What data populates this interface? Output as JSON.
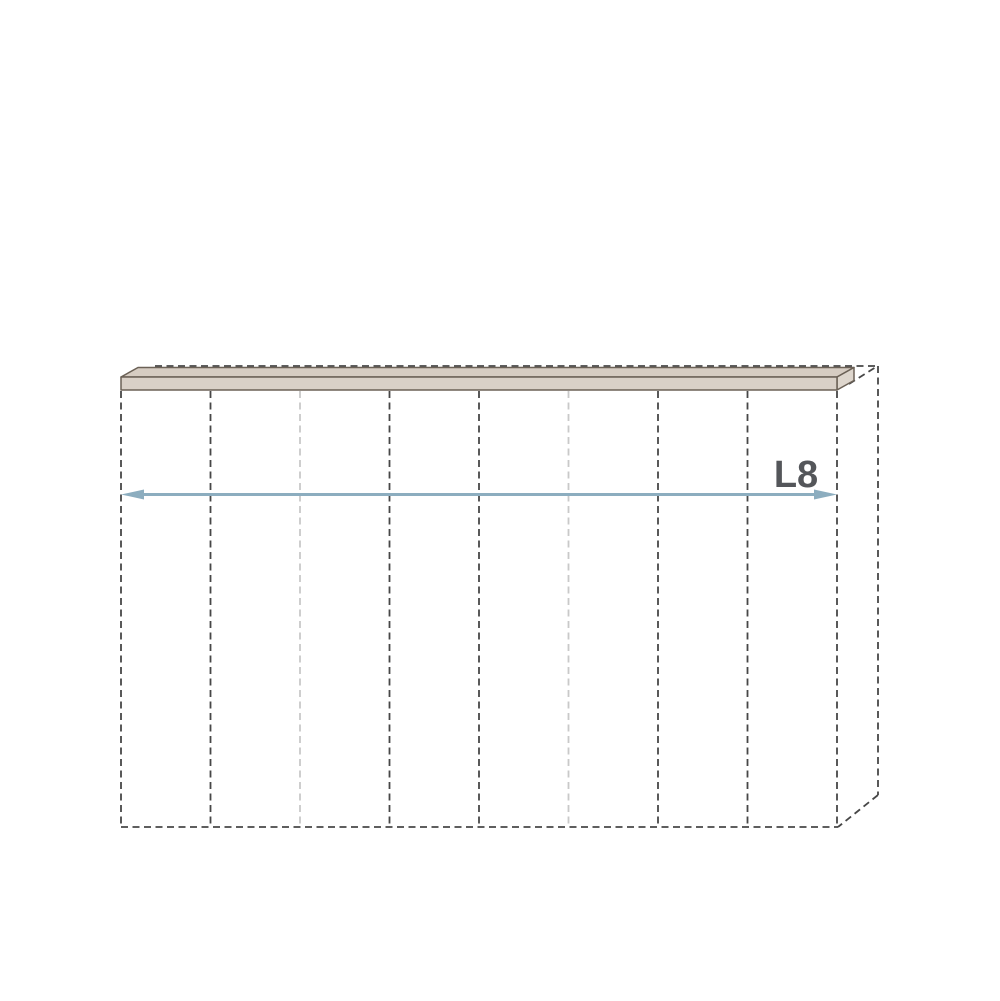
{
  "diagram": {
    "type": "wardrobe-configurator-dimension-drawing",
    "dimension_label": "L8",
    "highlighted_component": "top-panel",
    "sections_count": 8
  },
  "colors": {
    "background": "#ffffff",
    "dash-dark": "#474747",
    "dash-light": "#c9c9c9",
    "slab-top": "#d6ccc2",
    "slab-front": "#d9d0c7",
    "slab-end": "#ded6cd",
    "slab-outline": "#6b6156",
    "arrow": "#8cadbf",
    "label": "#54565a"
  }
}
